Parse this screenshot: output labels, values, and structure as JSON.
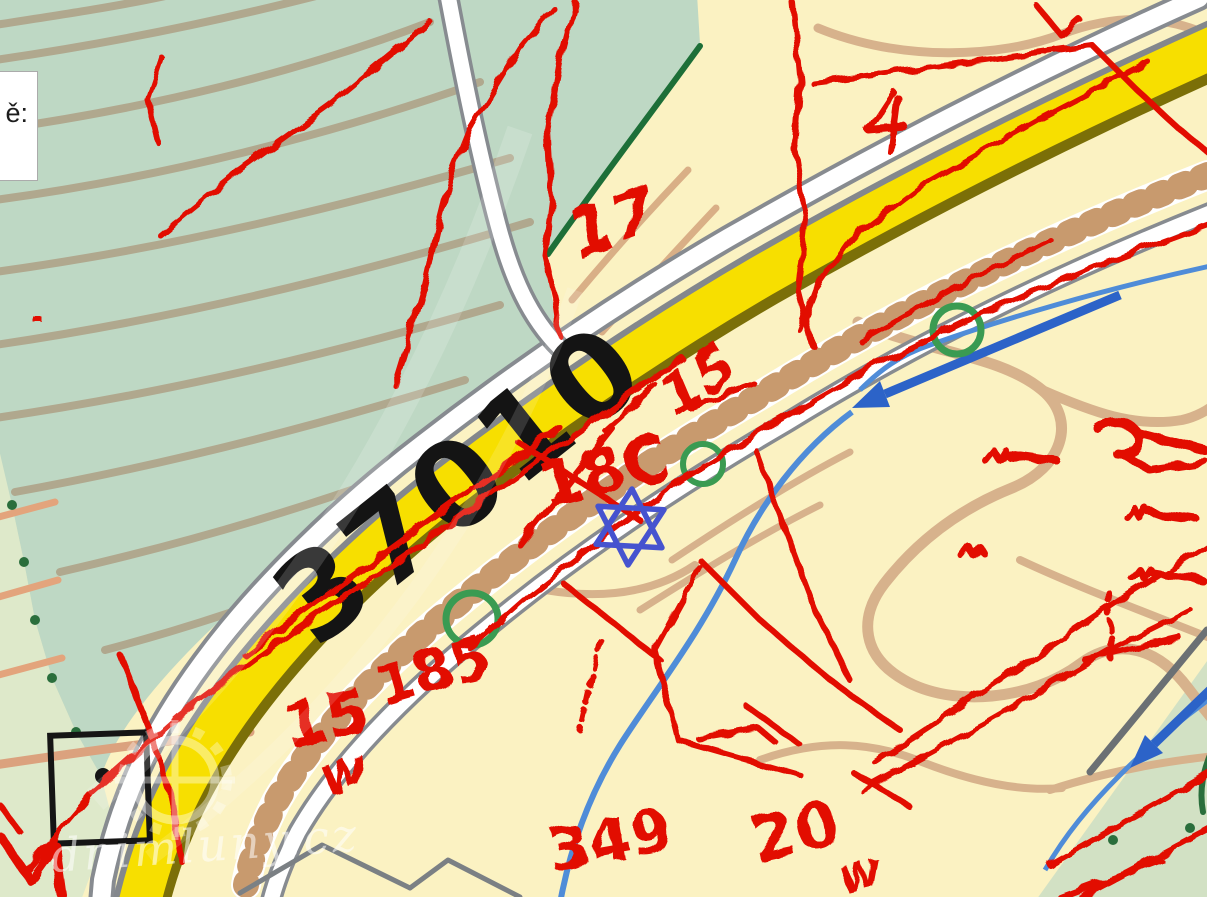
{
  "info_box": {
    "text": "ě:"
  },
  "map": {
    "road_number_label": "37010",
    "parcel_labels": [
      {
        "text": "17"
      },
      {
        "text": "18C"
      },
      {
        "text": "15"
      },
      {
        "text": "185"
      },
      {
        "text": "15"
      },
      {
        "text": "w"
      },
      {
        "text": "349"
      },
      {
        "text": "20"
      },
      {
        "text": "w"
      }
    ],
    "watermark_text": "dnimluny.cz",
    "colors": {
      "road_fill": "#f7df00",
      "road_shade": "#7b6f08",
      "terrain_green": "#bed8c4",
      "terrain_pale": "#fbf2c2",
      "contour_tan": "#d7b28c",
      "cadastral_red": "#e20800",
      "water_blue": "#2c63c8",
      "ring_green": "#3a9b52",
      "star_blue": "#4653cf"
    }
  }
}
